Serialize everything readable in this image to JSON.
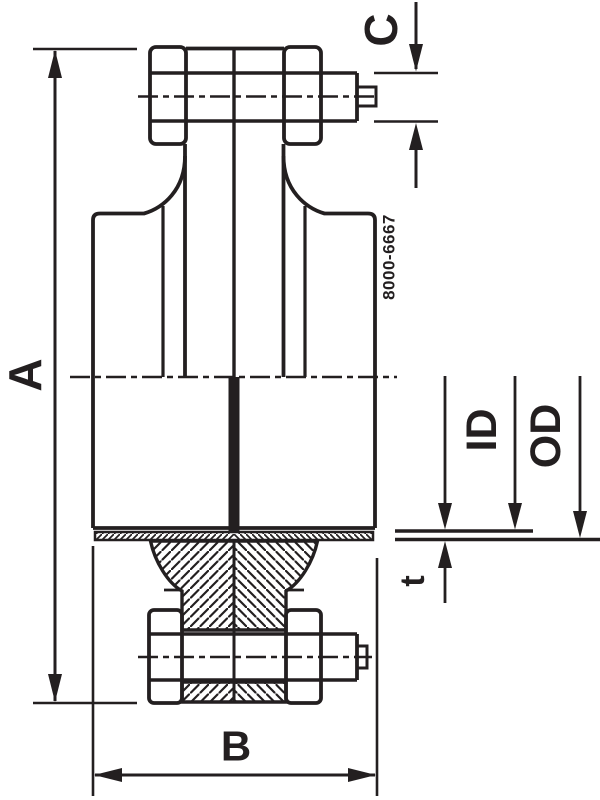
{
  "drawing": {
    "background_color": "#ffffff",
    "line_color": "#231f20",
    "part_number": "8000-6667",
    "labels": {
      "overall_height": "A",
      "flange_width": "B",
      "stud_projection": "C",
      "inner_diameter": "ID",
      "outer_diameter": "OD",
      "thickness": "t"
    }
  }
}
